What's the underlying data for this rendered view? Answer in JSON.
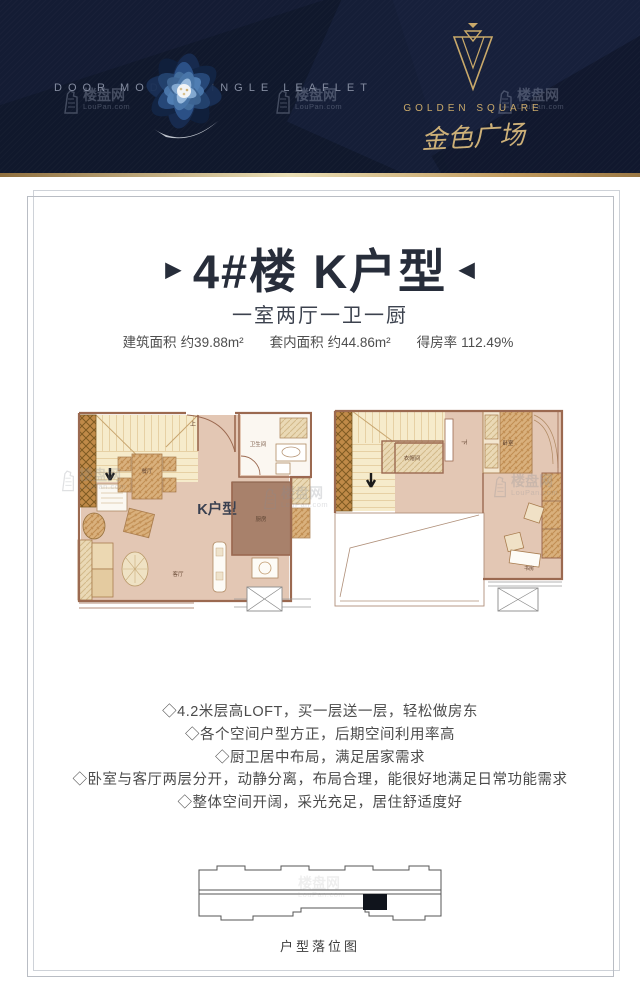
{
  "header": {
    "tagline": "DOOR MODEL SINGLE LEAFLET",
    "brand_en": "GOLDEN SQUARE",
    "brand_cn": "金色广场",
    "background_color": "#141c34",
    "accent_gold": "#c9a96a"
  },
  "title": {
    "left_arrow": "▶",
    "text": "4#楼 K户型",
    "right_arrow": "◀"
  },
  "subtitle": "一室两厅一卫一厨",
  "stats": {
    "items": [
      {
        "label": "建筑面积",
        "value": "约39.88m²"
      },
      {
        "label": "套内面积",
        "value": "约44.86m²"
      },
      {
        "label": "得房率",
        "value": "112.49%"
      }
    ]
  },
  "plans": {
    "floor1": {
      "unit_label": "K户型",
      "stairs_up": "上",
      "bathroom": "卫生间",
      "dining": "餐厅",
      "living": "客厅",
      "kitchen": "厨房"
    },
    "floor2": {
      "stairs_down": "下",
      "cloakroom": "衣帽间",
      "bedroom": "卧室",
      "study": "书房"
    }
  },
  "features": [
    "◇4.2米层高LOFT，买一层送一层，轻松做房东",
    "◇各个空间户型方正，后期空间利用率高",
    "◇厨卫居中布局，满足居家需求",
    "◇卧室与客厅两层分开，动静分离，布局合理，能很好地满足日常功能需求",
    "◇整体空间开阔，采光充足，居住舒适度好"
  ],
  "location": {
    "caption": "户型落位图"
  },
  "watermark": {
    "cn": "楼盘网",
    "en": "LouPan.com"
  }
}
